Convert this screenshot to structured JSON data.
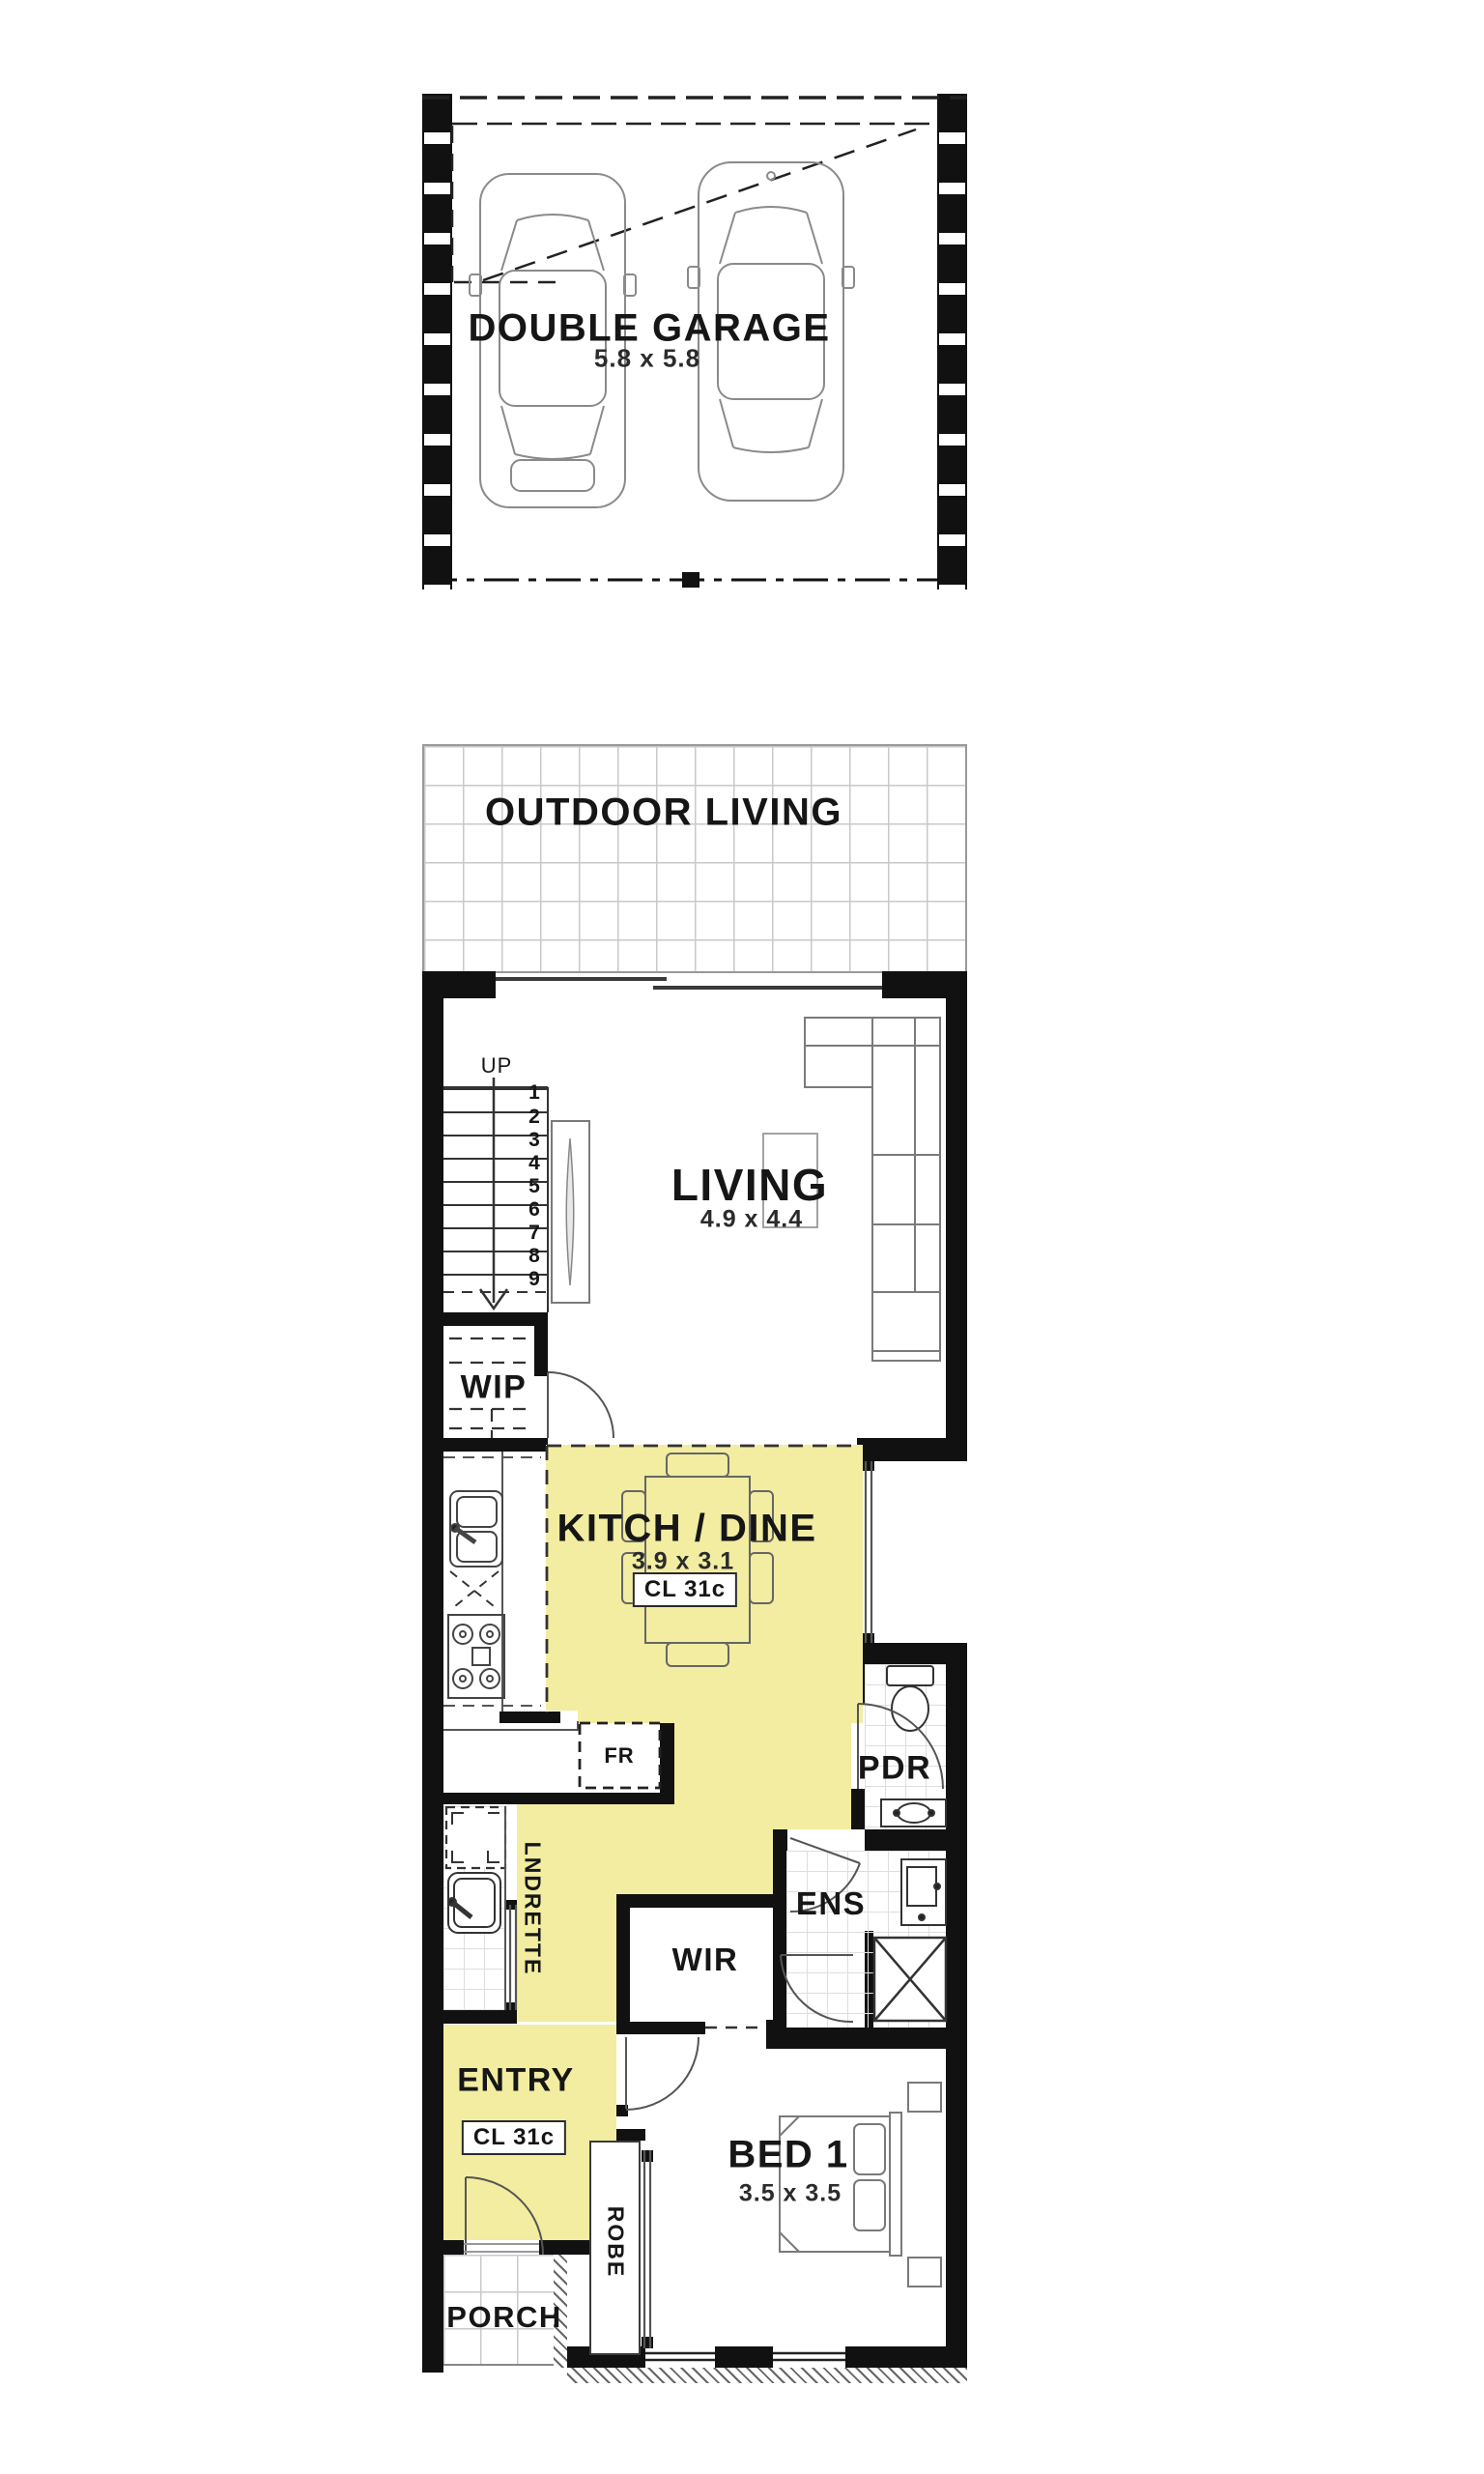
{
  "colors": {
    "highlight": "#F2EDA0",
    "wall": "#111111",
    "line": "#555555",
    "text": "#161616",
    "grid": "#c9c9c9"
  },
  "rooms": {
    "garage": {
      "label": "DOUBLE GARAGE",
      "dim": "5.8 x 5.8"
    },
    "outdoor": {
      "label": "OUTDOOR LIVING"
    },
    "living": {
      "label": "LIVING",
      "dim": "4.9 x 4.4"
    },
    "wip": {
      "label": "WIP"
    },
    "kitchdine": {
      "label": "KITCH / DINE",
      "dim": "3.9 x 3.1",
      "ceiling": "CL 31c"
    },
    "fridge": {
      "label": "FR"
    },
    "pdr": {
      "label": "PDR"
    },
    "ens": {
      "label": "ENS"
    },
    "wir": {
      "label": "WIR"
    },
    "lndrette": {
      "label": "LNDRETTE"
    },
    "entry": {
      "label": "ENTRY",
      "ceiling": "CL 31c"
    },
    "bed1": {
      "label": "BED 1",
      "dim": "3.5 x 3.5"
    },
    "robe": {
      "label": "ROBE"
    },
    "porch": {
      "label": "PORCH"
    }
  },
  "stairs": {
    "direction": "UP",
    "treads": [
      "1",
      "2",
      "3",
      "4",
      "5",
      "6",
      "7",
      "8",
      "9"
    ]
  }
}
